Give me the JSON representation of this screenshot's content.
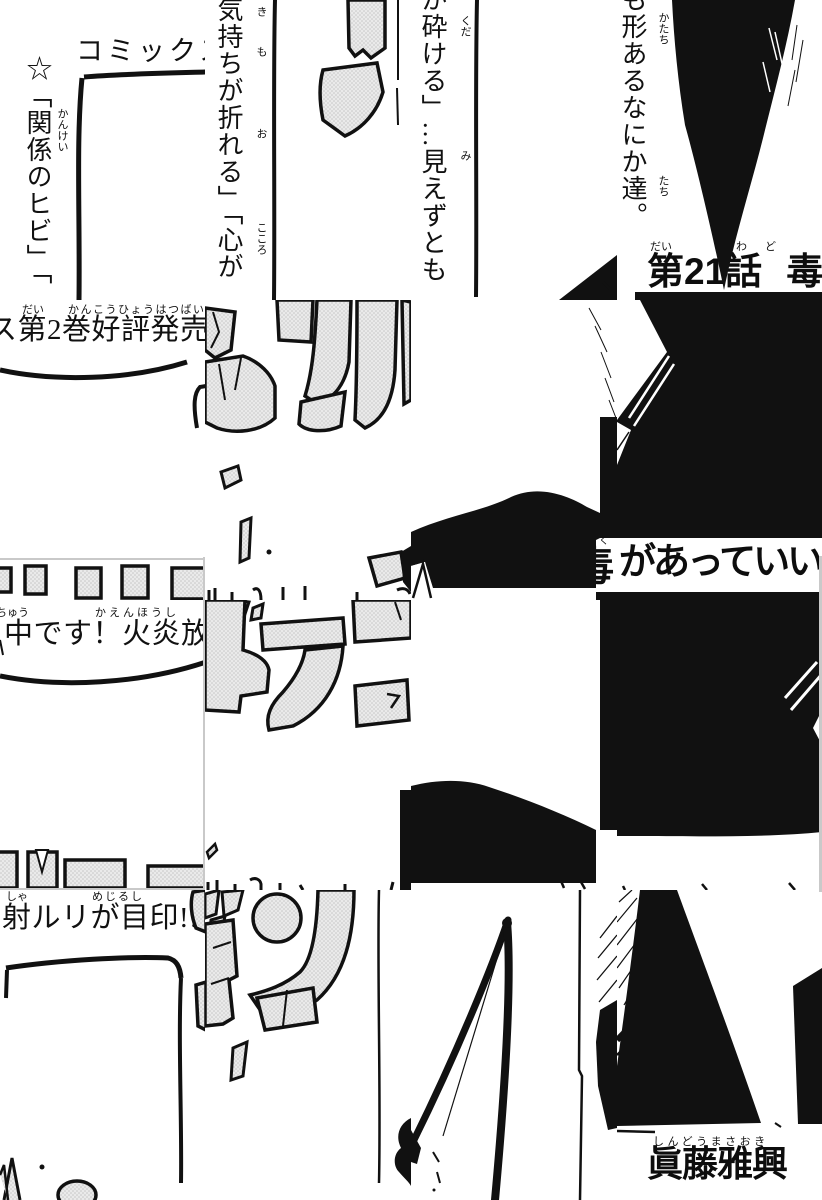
{
  "colors": {
    "paper": "#ffffff",
    "ink": "#111111",
    "screentone": "#eaeaea",
    "seam": "#c9c9c9"
  },
  "ad_banner": {
    "line1": "コミックス",
    "line2": "ス第2巻好評発売",
    "line2_ruby_dai": "だい",
    "line2_ruby_main": "かんこうひょうはつばい",
    "line3": "中です！火炎放",
    "line3_ruby_chu": "ちゅう",
    "line3_ruby_kaen": "かえんほうし",
    "line4": "射ルリが目印!!",
    "line4_ruby_sha": "しゃ",
    "line4_ruby_mejirushi": "めじるし"
  },
  "tagline": {
    "col1": "☆「関係のヒビ」「",
    "col1_ruby": "かんけい",
    "col2": "気持ちが折れる」「心が",
    "col2_ruby_ki": "き",
    "col2_ruby_mo": "も",
    "col2_ruby_o": "お",
    "col2_ruby_kokoro": "こころ",
    "col3": "が砕ける」…見えずとも",
    "col3_ruby_kuda": "くだ",
    "col3_ruby_mi": "み",
    "col4": "も形あるなにか達。",
    "col4_ruby_katachi": "かたち",
    "col4_ruby_tachi": "たち"
  },
  "chapter": {
    "label": "第21話 毒",
    "ruby_dai": "だい",
    "ruby_wa": "わ",
    "ruby_do": "ど",
    "fragment_toxin": "毒",
    "fragment_toxin_ruby": "く",
    "fragment_rest": "があっていい"
  },
  "author": {
    "name": "眞藤雅興",
    "ruby": "しんどうまさおき"
  }
}
